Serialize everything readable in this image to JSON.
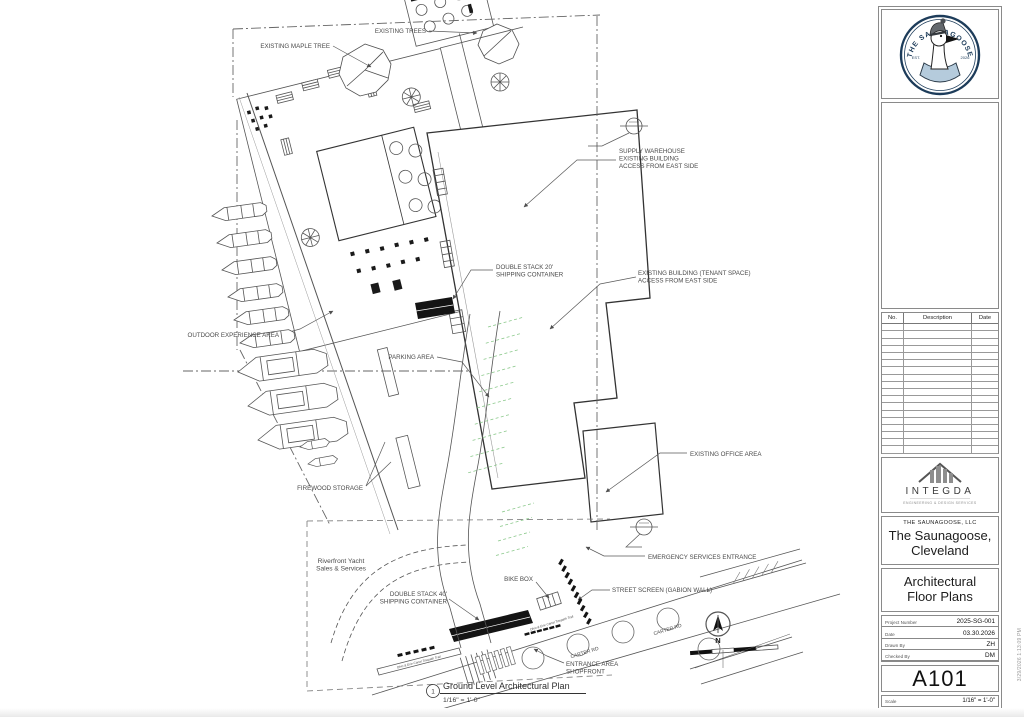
{
  "colors": {
    "linework": "#4f4f4f",
    "building_stroke": "#333333",
    "parking_green": "#8cc98c",
    "container_black": "#141414",
    "logo_navy": "#1d3c5a",
    "logo_hoodie_blue": "#b5cbdc"
  },
  "titleblock": {
    "logo": {
      "brand_arc": "THE SAUNAGOOSE",
      "est": "EST.",
      "year": "2026"
    },
    "revisions": {
      "headers": [
        "No.",
        "Description",
        "Date"
      ],
      "row_count": 18
    },
    "integda": {
      "name": "INTEGDA",
      "tagline": "ENGINEERING & DESIGN SERVICES"
    },
    "company": "THE SAUNAGOOSE, LLC",
    "project_name": "The Saunagoose, Cleveland",
    "sheet_title": "Architectural Floor Plans",
    "fields": [
      {
        "label": "Project Number",
        "value": "2025-SG-001"
      },
      {
        "label": "Date",
        "value": "03.30.2026"
      },
      {
        "label": "Drawn By",
        "value": "ZH"
      },
      {
        "label": "Checked By",
        "value": "DM"
      }
    ],
    "sheet_number": "A101",
    "scale_label": "Scale",
    "scale_value": "1/16\" = 1'-0\"",
    "print_stamp": "3/29/2026 1:13:09 PM"
  },
  "plan": {
    "view_title": {
      "number": "1",
      "title": "Ground Level Architectural Plan",
      "scale": "1/16\" = 1'-0\""
    },
    "north_letter": "N",
    "labels": [
      {
        "id": "existing-maple-tree",
        "lines": [
          "EXISTING MAPLE TREE"
        ],
        "x": 330,
        "y": 48,
        "anchor": "end"
      },
      {
        "id": "existing-trees",
        "lines": [
          "EXISTING TREES"
        ],
        "x": 426,
        "y": 33,
        "anchor": "end"
      },
      {
        "id": "supply-warehouse",
        "lines": [
          "SUPPLY WAREHOUSE",
          "EXISTING BUILDING",
          "ACCESS FROM EAST SIDE"
        ],
        "x": 619,
        "y": 153,
        "anchor": "start"
      },
      {
        "id": "double-stack-20",
        "lines": [
          "DOUBLE STACK 20'",
          "SHIPPING CONTAINER"
        ],
        "x": 496,
        "y": 269,
        "anchor": "start"
      },
      {
        "id": "existing-building-tenant",
        "lines": [
          "EXISTING BUILDING (TENANT SPACE)",
          "ACCESS FROM EAST SIDE"
        ],
        "x": 638,
        "y": 275,
        "anchor": "start"
      },
      {
        "id": "outdoor-experience-area",
        "lines": [
          "OUTDOOR EXPERIENCE AREA"
        ],
        "x": 279,
        "y": 337,
        "anchor": "end"
      },
      {
        "id": "parking-area",
        "lines": [
          "PARKING AREA"
        ],
        "x": 434,
        "y": 359,
        "anchor": "end"
      },
      {
        "id": "existing-office-area",
        "lines": [
          "EXISTING OFFICE AREA"
        ],
        "x": 690,
        "y": 456,
        "anchor": "start"
      },
      {
        "id": "firewood-storage",
        "lines": [
          "FIREWOOD STORAGE"
        ],
        "x": 363,
        "y": 490,
        "anchor": "end"
      },
      {
        "id": "riverfront-yacht",
        "lines": [
          "Riverfront Yacht",
          "Sales & Services"
        ],
        "x": 341,
        "y": 563,
        "anchor": "middle",
        "size": 6.6
      },
      {
        "id": "double-stack-40",
        "lines": [
          "DOUBLE STACK 40'",
          "SHIPPING CONTAINER"
        ],
        "x": 447,
        "y": 596,
        "anchor": "end"
      },
      {
        "id": "bike-box",
        "lines": [
          "BIKE BOX"
        ],
        "x": 533,
        "y": 581,
        "anchor": "end"
      },
      {
        "id": "emergency-services-entrance",
        "lines": [
          "EMERGENCY SERVICES ENTRANCE"
        ],
        "x": 648,
        "y": 559,
        "anchor": "start"
      },
      {
        "id": "street-screen",
        "lines": [
          "STREET SCREEN (GABION WALL)"
        ],
        "x": 612,
        "y": 592,
        "anchor": "start"
      },
      {
        "id": "entrance-area-shopfront",
        "lines": [
          "ENTRANCE AREA",
          "SHOPFRONT"
        ],
        "x": 566,
        "y": 666,
        "anchor": "start"
      },
      {
        "id": "carter-rd-1",
        "lines": [
          "CARTER RD"
        ],
        "x": 585,
        "y": 654,
        "anchor": "middle",
        "rot": -17,
        "size": 5
      },
      {
        "id": "carter-rd-2",
        "lines": [
          "CARTER RD"
        ],
        "x": 668,
        "y": 631,
        "anchor": "middle",
        "rot": -17,
        "size": 5
      },
      {
        "id": "towpath-trail-1",
        "lines": [
          "Ohio & Erie Canal Towpath Trail"
        ],
        "x": 419,
        "y": 663,
        "anchor": "middle",
        "rot": -14,
        "size": 3.2,
        "italic": true
      },
      {
        "id": "towpath-trail-2",
        "lines": [
          "Ohio & Erie Canal Towpath Trail"
        ],
        "x": 552,
        "y": 624,
        "anchor": "middle",
        "rot": -17,
        "size": 3.2,
        "italic": true
      }
    ]
  }
}
